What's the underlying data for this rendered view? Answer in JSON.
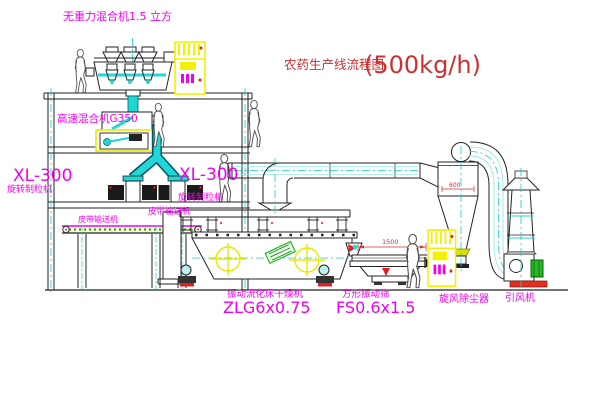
{
  "title": {
    "name": "农药生产线流程图",
    "capacity": "(500kg/h)"
  },
  "equipment_labels": {
    "gravity_mixer": "无重力混合机1.5 立方",
    "high_speed_mixer": "高速混合机G350",
    "granulator_left": {
      "model": "XL-300",
      "name": "旋转制粒机"
    },
    "granulator_right": {
      "model": "XL-300",
      "name": "旋转制粒机"
    },
    "belt_conveyor_upper": "皮带输送机",
    "belt_conveyor": "皮带输送机",
    "fluid_bed_dryer": {
      "name": "振动流化床干燥机",
      "model": "ZLG6x0.75"
    },
    "vibrating_screen": {
      "name": "方形振动筛",
      "model": "FS0.6x1.5"
    },
    "cyclone": "旋风除尘器",
    "induced_draft_fan": "引风机"
  },
  "dimensions": {
    "screen_length": "1500",
    "screen_height": "745",
    "cyclone_dim": "600"
  },
  "figures": {
    "worker_count": 5,
    "control_cabinet_count": 2
  },
  "colors": {
    "label_magenta": "#f000f0",
    "title_red": "#cc3030",
    "pipe_cyan": "#21d6d6",
    "cabinet_yellow": "#f2f200",
    "line_dark": "#222222",
    "conveyor_green": "#00aa00",
    "fan_base_red": "#e03020",
    "motor_green": "#2ab52a"
  }
}
